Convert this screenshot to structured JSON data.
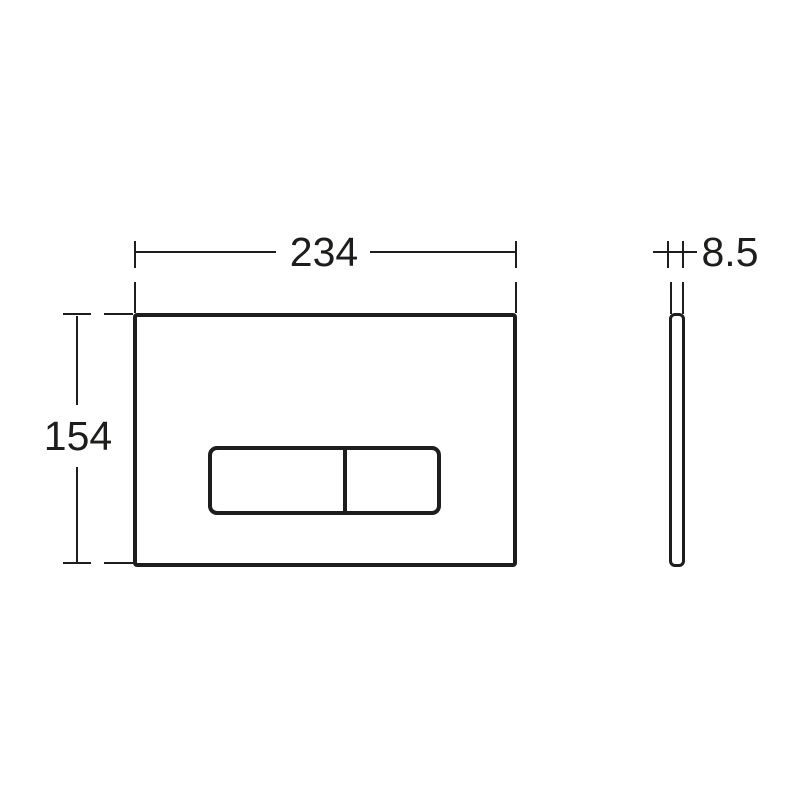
{
  "drawing": {
    "kind": "technical-dimension-drawing",
    "background_color": "#ffffff",
    "line_color": "#1d1d1b",
    "front_view": {
      "width_dimension_label": "234",
      "height_dimension_label": "154"
    },
    "side_view": {
      "thickness_dimension_label": "8.5"
    }
  }
}
